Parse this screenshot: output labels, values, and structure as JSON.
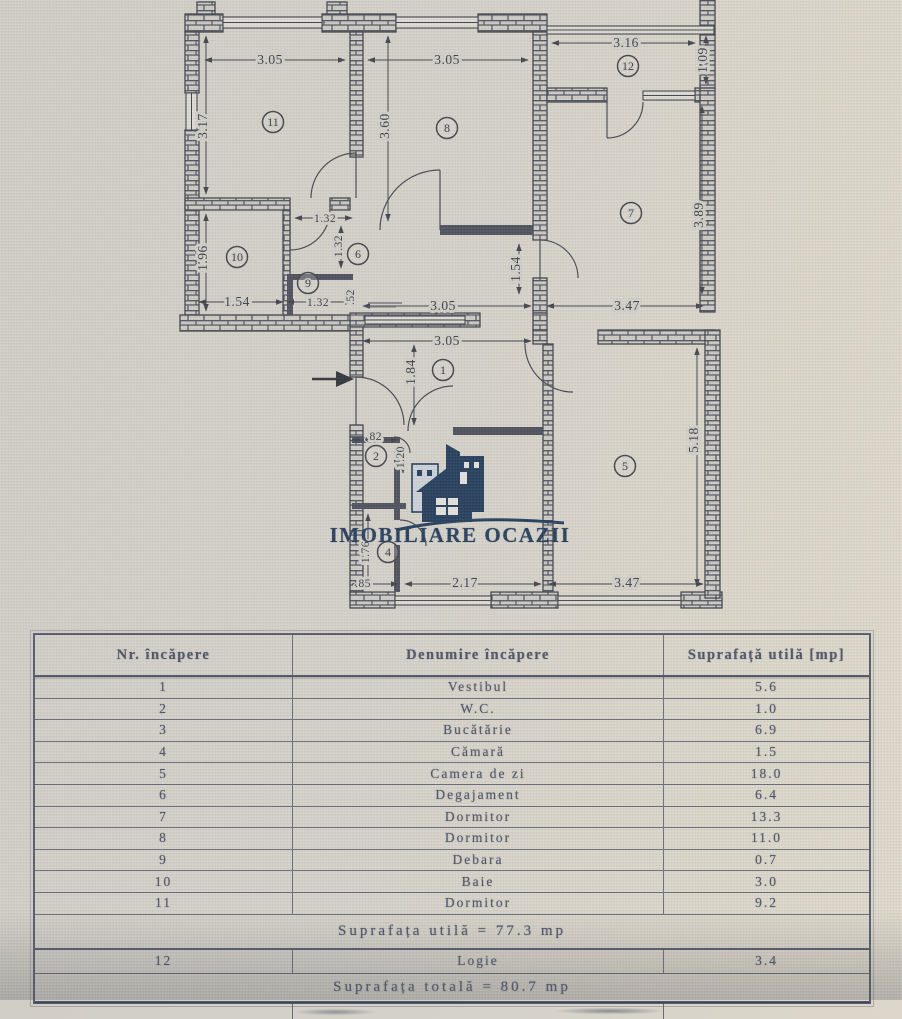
{
  "watermark": {
    "name": "IMOBILIARE OCAZII",
    "brand_color": "#1e3a5c",
    "logo_icon": "house-buildings-icon"
  },
  "plan": {
    "entry_arrow": "entry-direction-right",
    "rooms": [
      {
        "n": "1",
        "x": 443,
        "y": 370
      },
      {
        "n": "2",
        "x": 376,
        "y": 456
      },
      {
        "n": "4",
        "x": 388,
        "y": 552
      },
      {
        "n": "5",
        "x": 625,
        "y": 466
      },
      {
        "n": "6",
        "x": 358,
        "y": 254
      },
      {
        "n": "7",
        "x": 631,
        "y": 213
      },
      {
        "n": "8",
        "x": 447,
        "y": 128
      },
      {
        "n": "9",
        "x": 308,
        "y": 283
      },
      {
        "n": "10",
        "x": 237,
        "y": 257
      },
      {
        "n": "11",
        "x": 273,
        "y": 122
      },
      {
        "n": "12",
        "x": 628,
        "y": 66
      }
    ],
    "dim_labels": [
      {
        "t": "3.05",
        "x": 270,
        "y": 64
      },
      {
        "t": "3.05",
        "x": 447,
        "y": 64
      },
      {
        "t": "3.16",
        "x": 626,
        "y": 47
      },
      {
        "t": "1.09",
        "x": 707,
        "y": 60,
        "r": -90
      },
      {
        "t": "3.17",
        "x": 207,
        "y": 126,
        "r": -90
      },
      {
        "t": "3.60",
        "x": 389,
        "y": 126,
        "r": -90
      },
      {
        "t": "3.89",
        "x": 703,
        "y": 215,
        "r": -90
      },
      {
        "t": "1.96",
        "x": 207,
        "y": 258,
        "r": -90
      },
      {
        "t": "1.32",
        "x": 325,
        "y": 222,
        "s": true
      },
      {
        "t": "1.32",
        "x": 342,
        "y": 246,
        "r": -90,
        "s": true
      },
      {
        "t": "1.54",
        "x": 520,
        "y": 269,
        "r": -90
      },
      {
        "t": "1.54",
        "x": 237,
        "y": 306
      },
      {
        "t": "1.32",
        "x": 318,
        "y": 306,
        "s": true
      },
      {
        "t": ".52",
        "x": 354,
        "y": 297,
        "r": -90,
        "s": true
      },
      {
        "t": "3.05",
        "x": 443,
        "y": 310
      },
      {
        "t": "3.47",
        "x": 627,
        "y": 310
      },
      {
        "t": "3.05",
        "x": 447,
        "y": 345
      },
      {
        "t": "1.84",
        "x": 415,
        "y": 372,
        "r": -90
      },
      {
        "t": ".82",
        "x": 374,
        "y": 440,
        "s": true
      },
      {
        "t": "1.20",
        "x": 404,
        "y": 457,
        "r": -90,
        "s": true
      },
      {
        "t": "1.76",
        "x": 369,
        "y": 552,
        "r": -90,
        "s": true
      },
      {
        "t": ".85",
        "x": 363,
        "y": 587,
        "s": true
      },
      {
        "t": "2.17",
        "x": 465,
        "y": 587
      },
      {
        "t": "3.47",
        "x": 627,
        "y": 587
      },
      {
        "t": "5.18",
        "x": 698,
        "y": 440,
        "r": -90
      }
    ]
  },
  "table": {
    "headers": [
      "Nr. încăpere",
      "Denumire încăpere",
      "Suprafață utilă [mp]"
    ],
    "rows": [
      [
        "1",
        "Vestibul",
        "5.6"
      ],
      [
        "2",
        "W.C.",
        "1.0"
      ],
      [
        "3",
        "Bucătărie",
        "6.9"
      ],
      [
        "4",
        "Cămară",
        "1.5"
      ],
      [
        "5",
        "Camera de zi",
        "18.0"
      ],
      [
        "6",
        "Degajament",
        "6.4"
      ],
      [
        "7",
        "Dormitor",
        "13.3"
      ],
      [
        "8",
        "Dormitor",
        "11.0"
      ],
      [
        "9",
        "Debara",
        "0.7"
      ],
      [
        "10",
        "Baie",
        "3.0"
      ],
      [
        "11",
        "Dormitor",
        "9.2"
      ]
    ],
    "subtotal": "Suprafața utilă = 77.3 mp",
    "extra_row": [
      "12",
      "Logie",
      "3.4"
    ],
    "total": "Suprafața totală = 80.7 mp"
  }
}
